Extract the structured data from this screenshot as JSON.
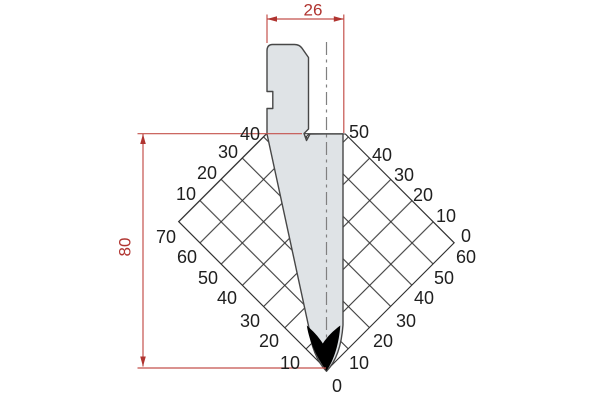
{
  "drawing": {
    "kind": "press-brake punch technical drawing",
    "dim": {
      "width": "26",
      "height": "80"
    },
    "scale": {
      "upper_left": [
        "40",
        "30",
        "20",
        "10"
      ],
      "lower_left": [
        "70",
        "60",
        "50",
        "40",
        "30",
        "20",
        "10"
      ],
      "apex": "0",
      "lower_right": [
        "10",
        "20",
        "30",
        "40",
        "50",
        "60"
      ],
      "upper_right": [
        "50",
        "40",
        "30",
        "20",
        "10",
        "0"
      ]
    },
    "colors": {
      "dimension_red": "#b03430",
      "dimension_line_red": "#c4524c",
      "punch_fill": "#dfe3e6",
      "punch_outline": "#474747",
      "grid_line": "#2f2f2f",
      "tip_black": "#000000",
      "centerline_gray": "#808080"
    }
  }
}
